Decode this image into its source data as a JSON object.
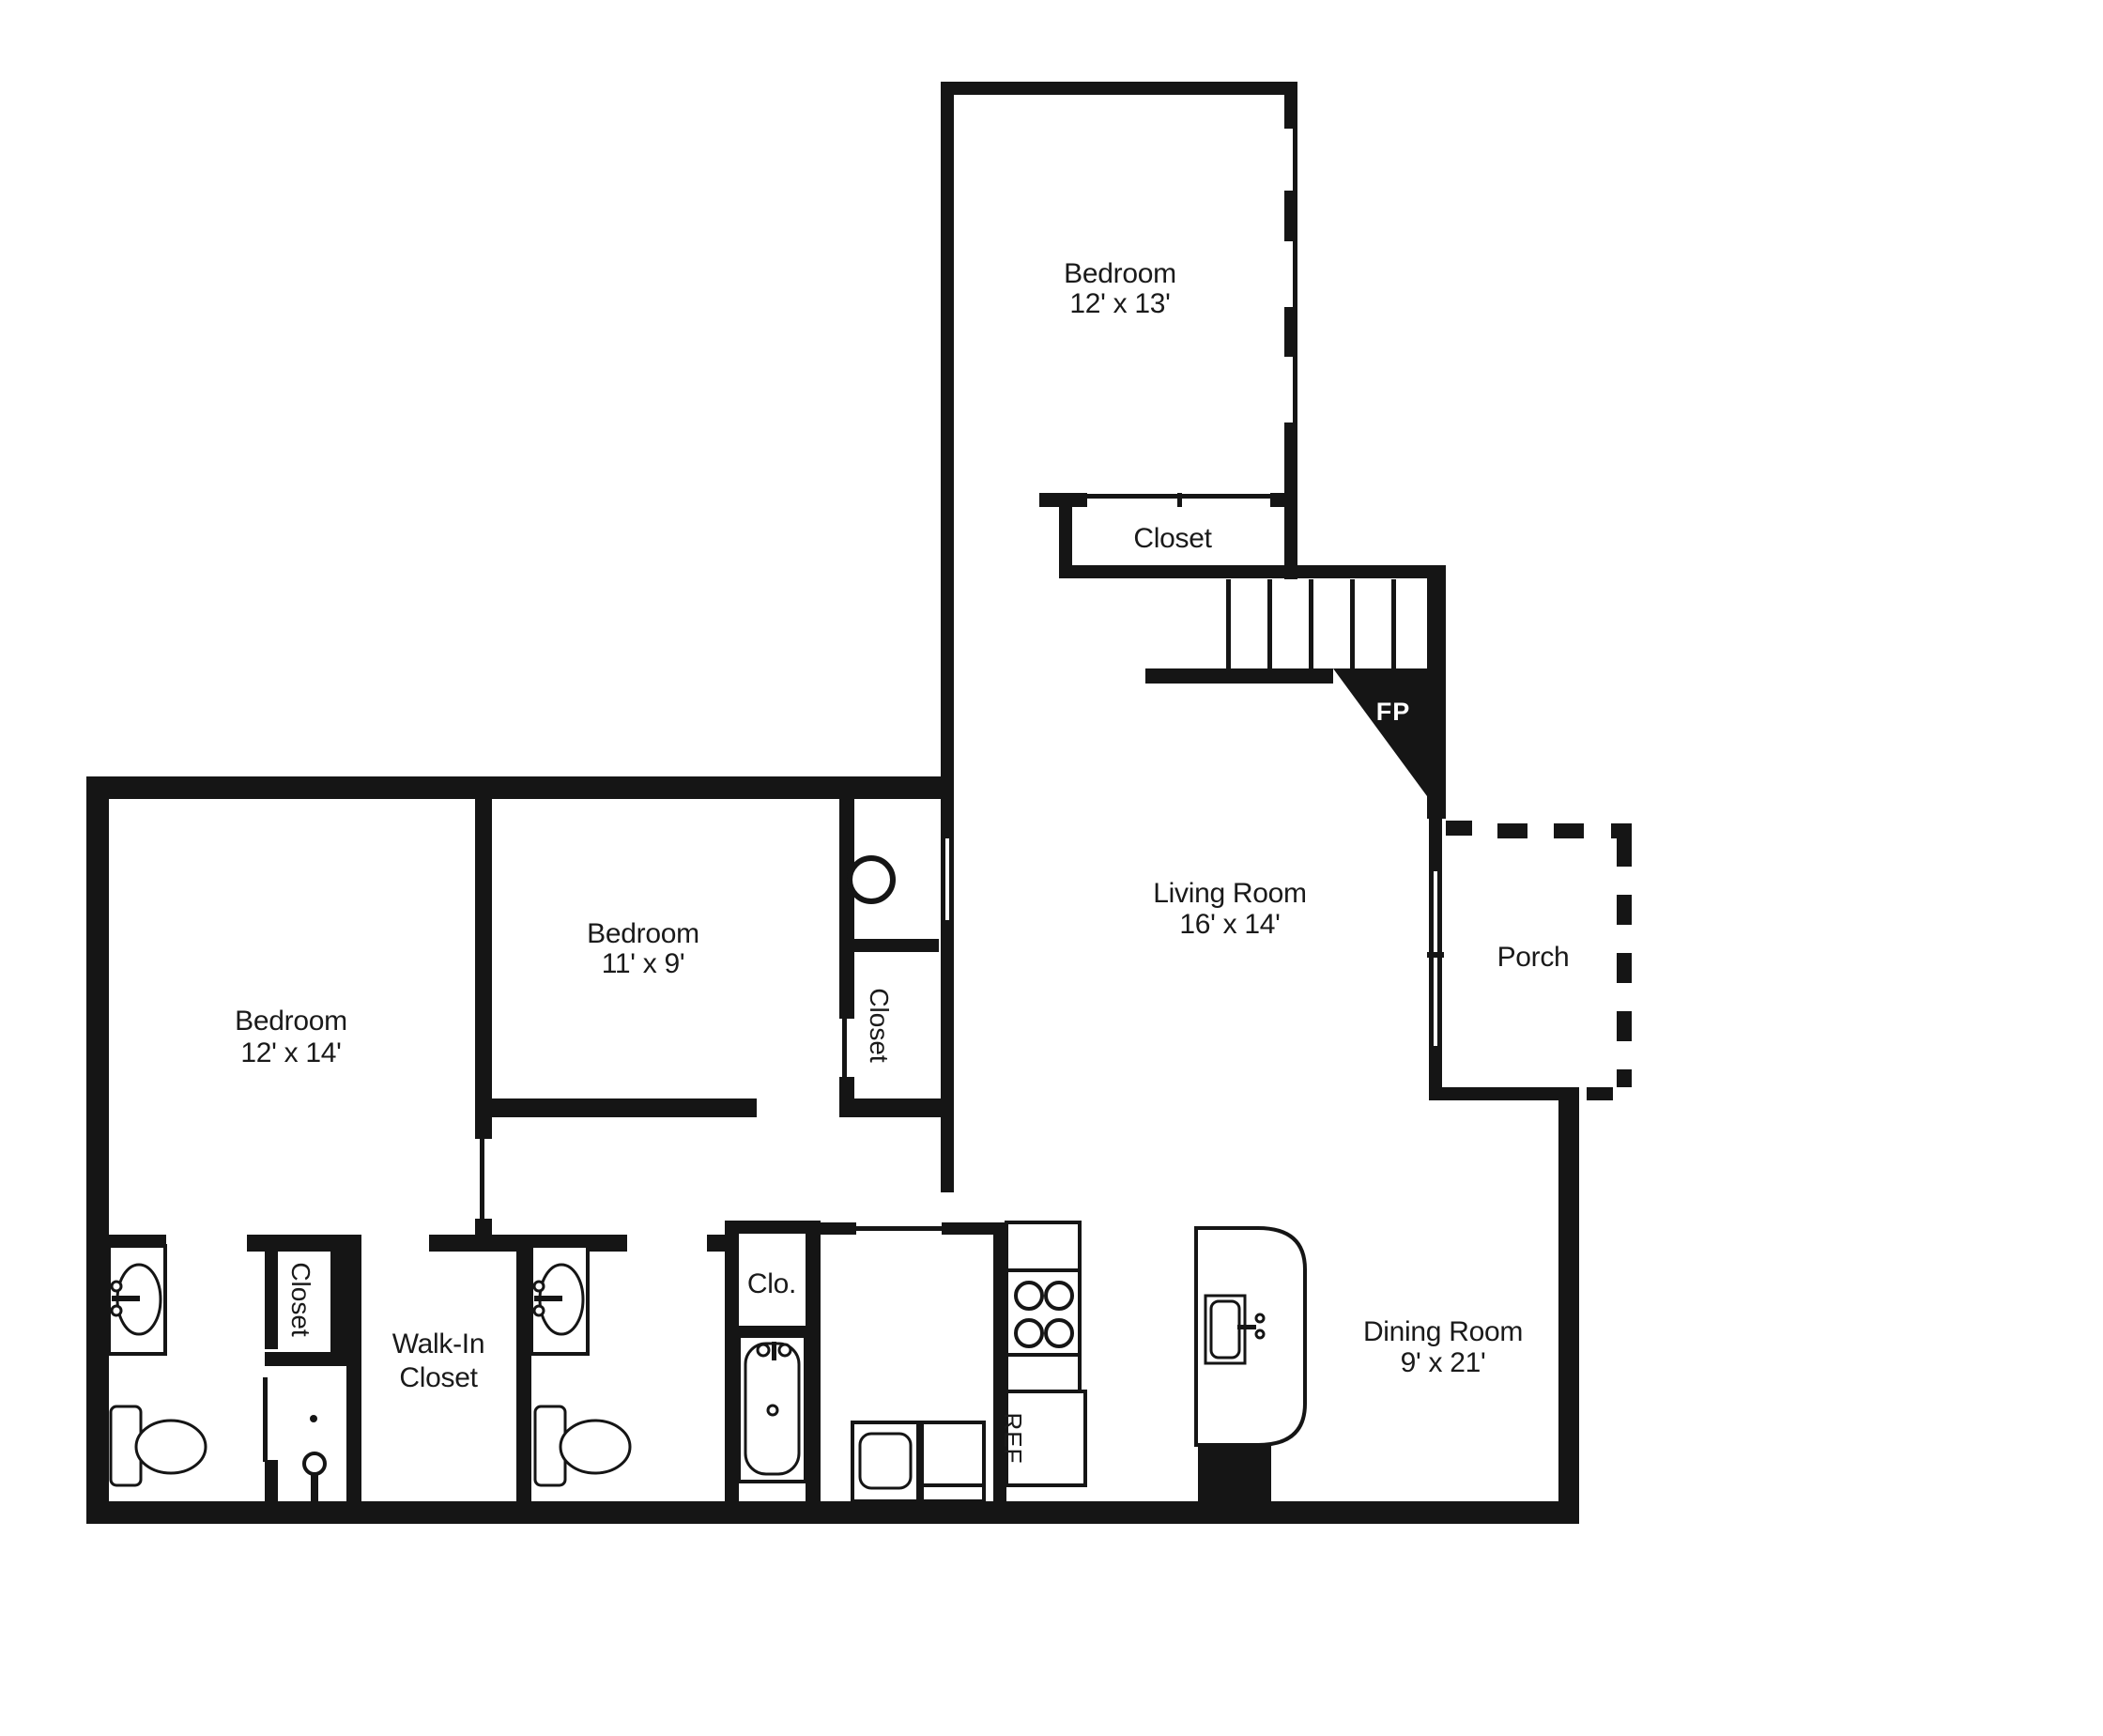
{
  "plan": {
    "type": "apartment-floor-plan",
    "colors": {
      "walls": "#151515",
      "text": "#1a1a1a",
      "background": "#ffffff",
      "fireplace_label": "#ffffff"
    },
    "rooms": {
      "bedroom_upper": {
        "label": "Bedroom",
        "dims": "12' x 13'"
      },
      "upper_closet": {
        "label": "Closet"
      },
      "living_room": {
        "label": "Living Room",
        "dims": "16' x 14'"
      },
      "fireplace": {
        "label": "FP"
      },
      "porch": {
        "label": "Porch"
      },
      "bedroom_master": {
        "label": "Bedroom",
        "dims": "12' x 14'"
      },
      "bedroom_middle": {
        "label": "Bedroom",
        "dims": "11' x 9'"
      },
      "hall_closet": {
        "label": "Closet"
      },
      "bath_closet": {
        "label": "Closet"
      },
      "walkin_closet": {
        "label1": "Walk-In",
        "label2": "Closet"
      },
      "clo": {
        "label": "Clo."
      },
      "refrigerator": {
        "label": "REF"
      },
      "dining_room": {
        "label": "Dining Room",
        "dims": "9' x 21'"
      }
    },
    "features": [
      "stairs",
      "fireplace",
      "sliding-glass-door",
      "porch-dashed-outline",
      "two-bathrooms",
      "bathtub",
      "shower",
      "water-heater",
      "stove-4-burner",
      "refrigerator",
      "kitchen-island-with-sink",
      "washer-dryer"
    ]
  }
}
